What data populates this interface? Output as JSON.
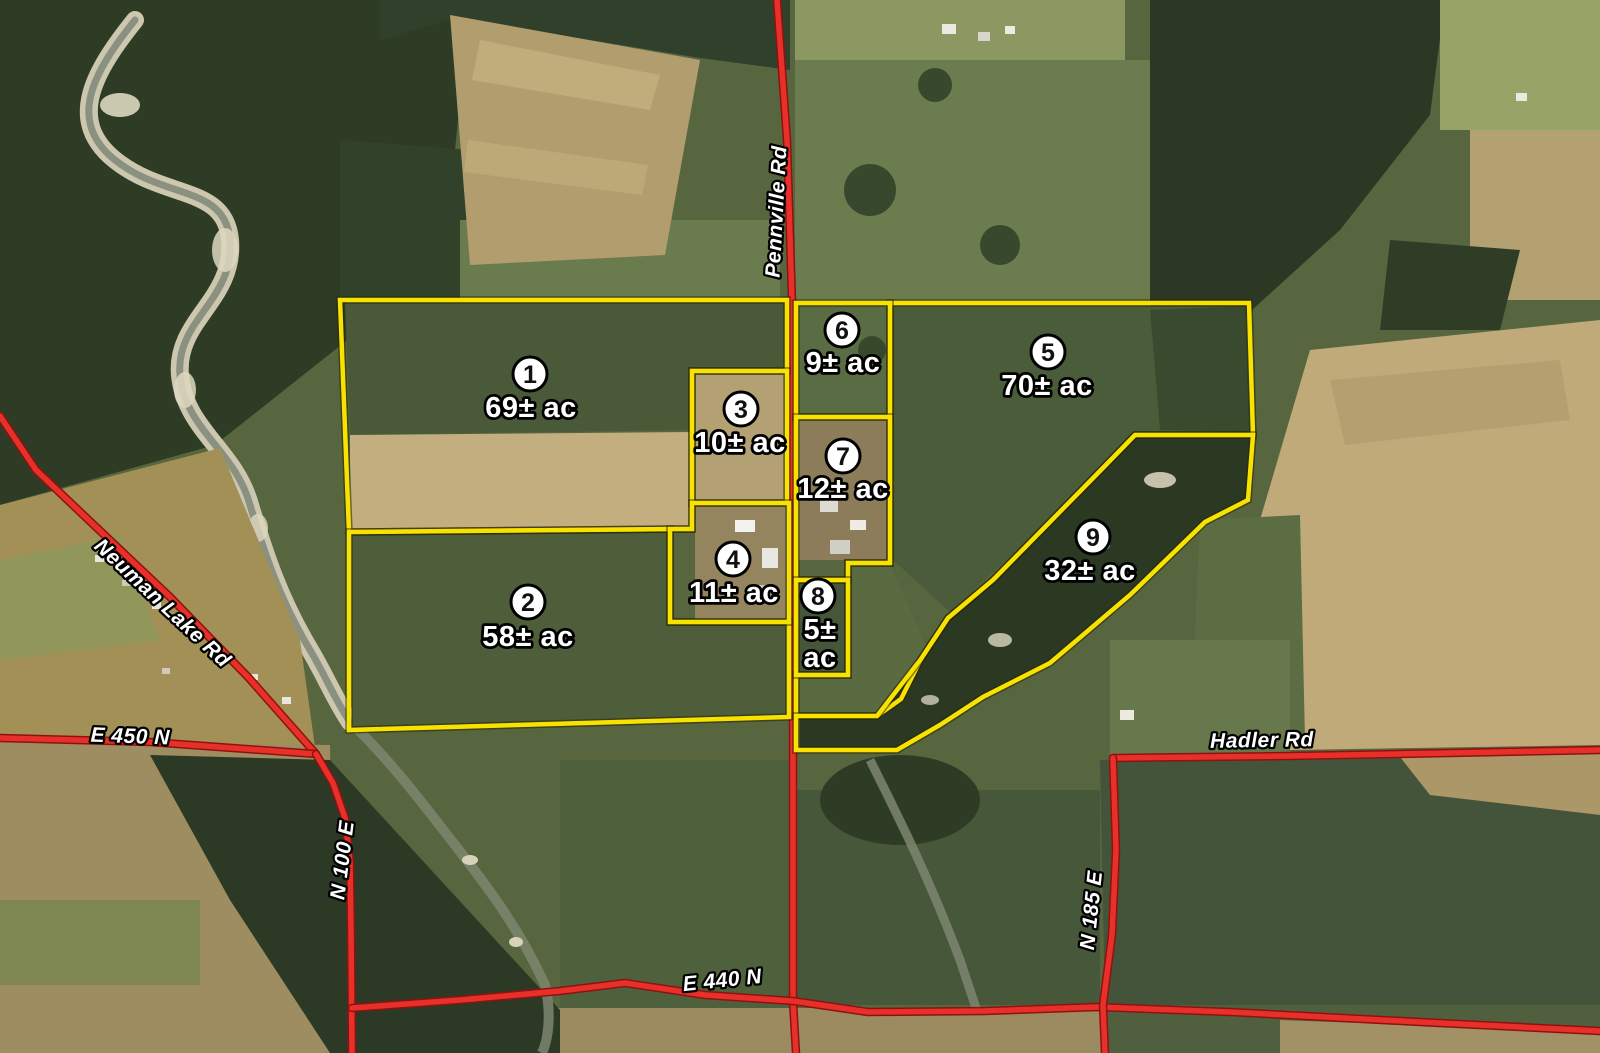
{
  "map": {
    "type": "aerial-tract-map",
    "tracts": [
      {
        "id": "tract-1",
        "number": "1",
        "acreage": "69± ac",
        "label_lines": [
          "69± ac"
        ],
        "circle": {
          "x": 530,
          "y": 374
        },
        "label": {
          "x": 531,
          "y": 408
        },
        "outline": "340,300 787,300 787,371 692,371 692,529 349,532"
      },
      {
        "id": "tract-2",
        "number": "2",
        "acreage": "58± ac",
        "label_lines": [
          "58± ac"
        ],
        "circle": {
          "x": 528,
          "y": 602
        },
        "label": {
          "x": 528,
          "y": 637
        },
        "outline": "349,532 670,529 670,622 789,622 789,717 349,730"
      },
      {
        "id": "tract-3",
        "number": "3",
        "acreage": "10± ac",
        "label_lines": [
          "10± ac"
        ],
        "circle": {
          "x": 741,
          "y": 409
        },
        "label": {
          "x": 740,
          "y": 443
        },
        "outline": "692,371 787,371 787,503 692,503"
      },
      {
        "id": "tract-4",
        "number": "4",
        "acreage": "11± ac",
        "label_lines": [
          "11± ac"
        ],
        "circle": {
          "x": 733,
          "y": 559
        },
        "label": {
          "x": 734,
          "y": 593
        },
        "outline": "692,503 789,503 789,622 670,622 670,529 692,529"
      },
      {
        "id": "tract-5",
        "number": "5",
        "acreage": "70± ac",
        "label_lines": [
          "70± ac"
        ],
        "circle": {
          "x": 1048,
          "y": 352
        },
        "label": {
          "x": 1047,
          "y": 386
        },
        "outline": "890,303 1249,303 1253,435 1135,435 1098,473 1045,527 993,580 948,618 921,659 901,699 877,716 796,716 796,675 848,675 848,563 890,563"
      },
      {
        "id": "tract-6",
        "number": "6",
        "acreage": "9± ac",
        "label_lines": [
          "9± ac"
        ],
        "circle": {
          "x": 842,
          "y": 330
        },
        "label": {
          "x": 843,
          "y": 363
        },
        "outline": "796,303 890,303 890,417 796,417"
      },
      {
        "id": "tract-7",
        "number": "7",
        "acreage": "12± ac",
        "label_lines": [
          "12± ac"
        ],
        "circle": {
          "x": 843,
          "y": 456
        },
        "label": {
          "x": 843,
          "y": 489
        },
        "outline": "796,417 890,417 890,563 848,563 848,580 796,580"
      },
      {
        "id": "tract-8",
        "number": "8",
        "acreage": "5± ac",
        "label_lines": [
          "5±",
          "ac"
        ],
        "circle": {
          "x": 818,
          "y": 596
        },
        "label": {
          "x": 820,
          "y": 630
        },
        "outline": "796,580 848,580 848,675 796,675"
      },
      {
        "id": "tract-9",
        "number": "9",
        "acreage": "32± ac",
        "label_lines": [
          "32± ac"
        ],
        "circle": {
          "x": 1093,
          "y": 537
        },
        "label": {
          "x": 1090,
          "y": 571
        },
        "outline": "1135,435 1253,435 1248,500 1205,522 1130,595 1050,663 983,697 940,725 897,750 796,750 796,716 877,716 921,659 948,618 993,580 1045,527 1098,473"
      }
    ],
    "roads": [
      {
        "id": "pennville-rd",
        "name": "Pennville Rd",
        "points": "777,0 787,140 792,300 793,600 793,880 793,1001 796,1053",
        "label": {
          "x": 783,
          "y": 212,
          "rotation": -87
        }
      },
      {
        "id": "neuman-lake-rd",
        "name": "Neuman Lake Rd",
        "points": "0,416 36,470 96,527 170,597 248,677 316,754",
        "label": {
          "x": 158,
          "y": 608,
          "rotation": 43
        }
      },
      {
        "id": "e-450-n",
        "name": "E 450 N",
        "points": "0,738 150,742 316,754",
        "label": {
          "x": 130,
          "y": 743,
          "rotation": 2
        }
      },
      {
        "id": "n-100-e",
        "name": "N 100 E",
        "points": "316,754 333,783 345,818 350,862 351,930 352,1053",
        "label": {
          "x": 349,
          "y": 861,
          "rotation": -83
        }
      },
      {
        "id": "e-440-n",
        "name": "E 440 N",
        "points": "352,1008 460,1000 560,991 625,983 705,995 793,1001 868,1012 985,1011 1097,1007 1230,1012 1420,1022 1600,1031",
        "label": {
          "x": 723,
          "y": 987,
          "rotation": -6
        }
      },
      {
        "id": "hadler-rd",
        "name": "Hadler Rd",
        "points": "1113,758 1290,756 1450,753 1600,750",
        "label": {
          "x": 1262,
          "y": 747,
          "rotation": -1
        }
      },
      {
        "id": "n-185-e",
        "name": "N 185 E",
        "points": "1113,758 1116,850 1112,935 1103,1005 1105,1053",
        "label": {
          "x": 1098,
          "y": 911,
          "rotation": -84
        }
      }
    ],
    "colors": {
      "road": "#e8302a",
      "road_casing": "#8e120f",
      "boundary": "#f8e300",
      "label_fill": "#ffffff",
      "label_stroke": "#000000",
      "circle_fill": "#ffffff",
      "number_fill": "#111111"
    }
  }
}
